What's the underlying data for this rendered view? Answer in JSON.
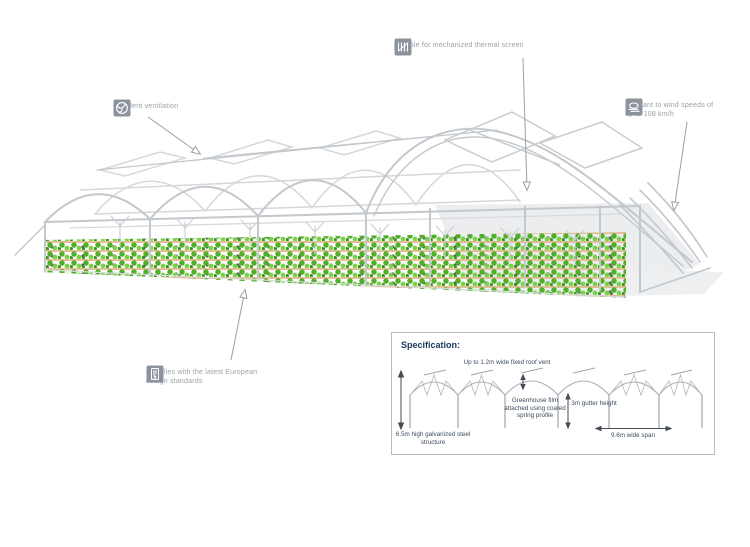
{
  "callouts": {
    "ventilation": {
      "icon": "fan-icon",
      "label": "excellent ventilation"
    },
    "thermal_screen": {
      "icon": "thermal-screen-icon",
      "label": "suitable for mechanized thermal screen"
    },
    "wind": {
      "icon": "wind-icon",
      "label": "resistant to wind speeds of up to 108 km/h"
    },
    "standards": {
      "icon": "certificate-icon",
      "label": "complies with the latest European design standards"
    }
  },
  "specification": {
    "title": "Specification:",
    "roof_vent_label": "Up to 1.2m wide fixed roof vent",
    "film_label": "Greenhouse film attached using coated spring profile",
    "gutter_label": "3m gutter height",
    "structure_label": "6.5m high galvanized steel structure",
    "span_label": "9.6m wide span"
  },
  "colors": {
    "label_text": "#98a0a7",
    "icon_background": "#8d939c",
    "spec_title": "#1c3a60",
    "spec_text": "#3c4b5c",
    "frame_line": "#c3c8cd",
    "plant_green": "#4fae2a",
    "dimension_line": "#444c57"
  }
}
